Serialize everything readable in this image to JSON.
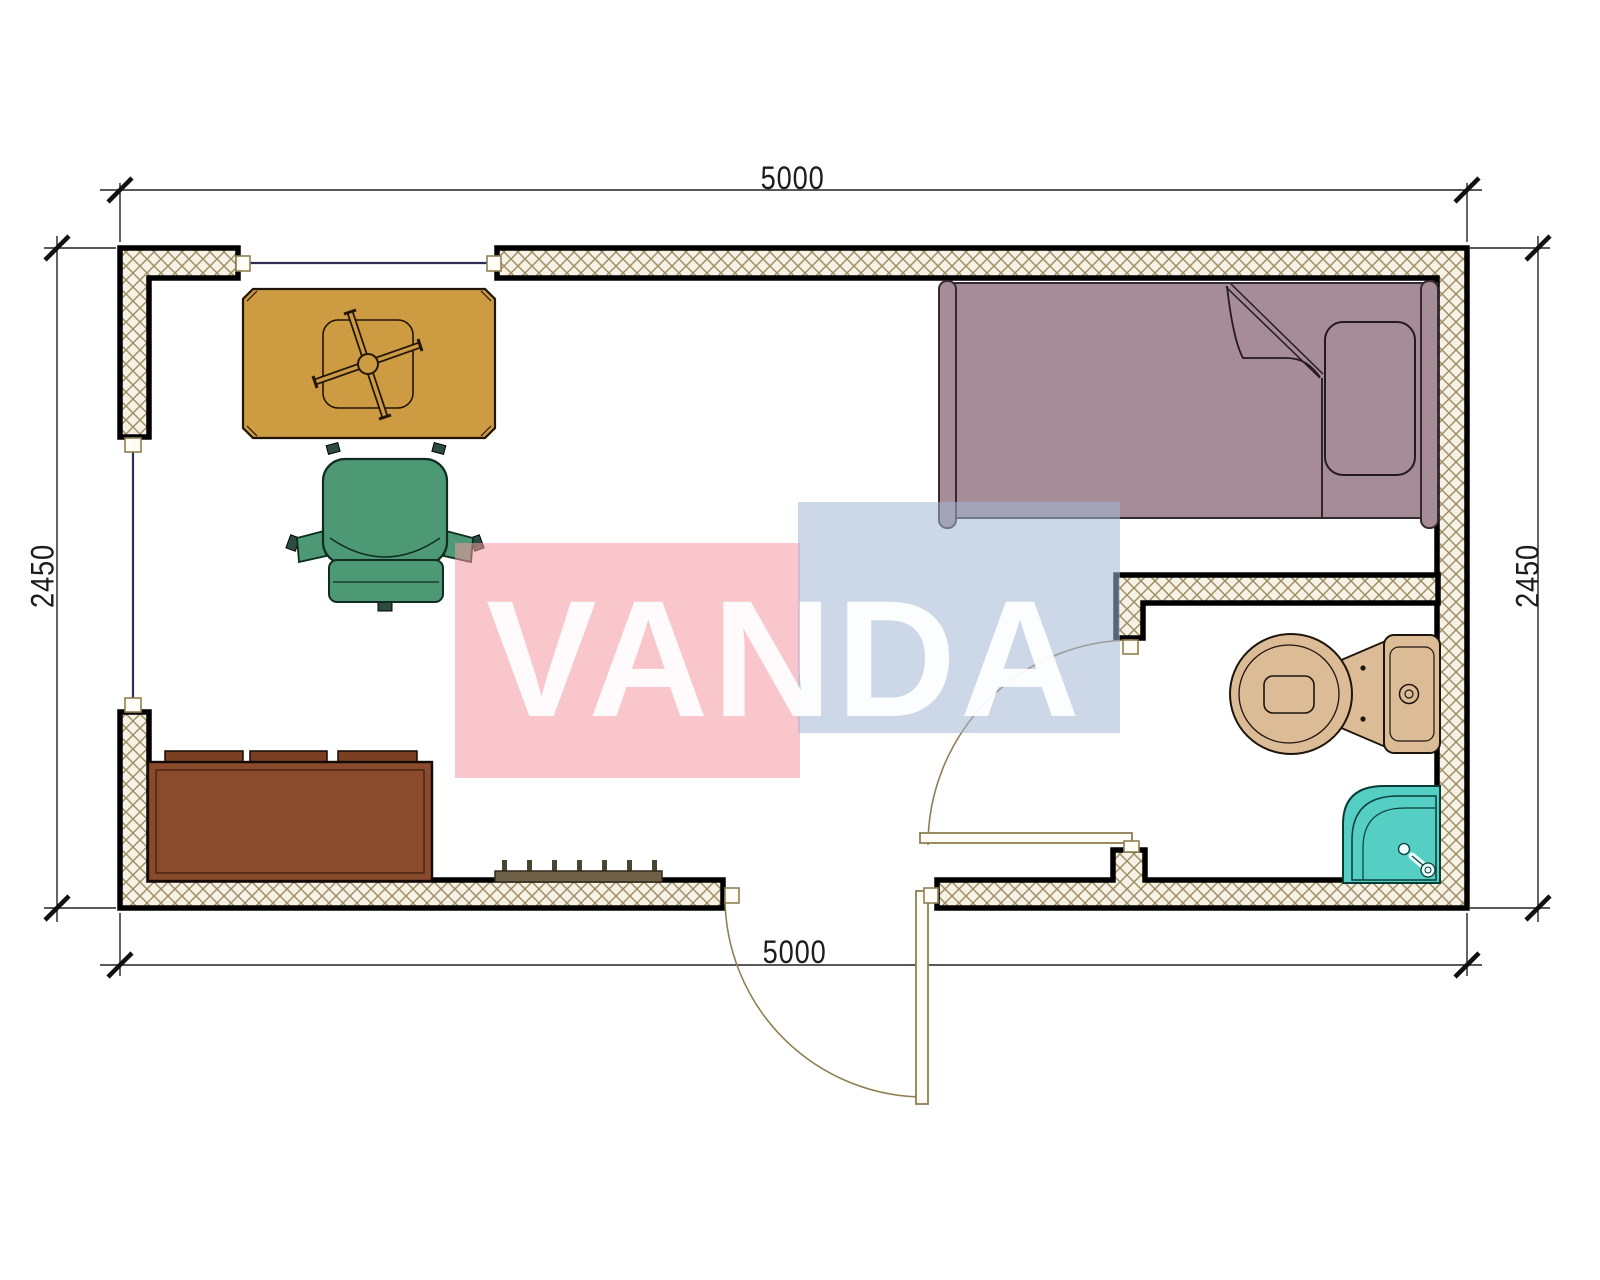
{
  "drawing": {
    "title_visible_text": [
      "5000",
      "2450",
      "VANDA"
    ],
    "dimensions": {
      "top": "5000",
      "bottom": "5000",
      "left": "2450",
      "right": "2450"
    },
    "watermark": {
      "text": "VANDA",
      "pink_square_color": "#F497A2",
      "blue_square_color": "#A2B8D5",
      "text_color": "#FFFFFF"
    },
    "walls": {
      "fill": "#F6F2E6",
      "hatch_color": "#A08F66",
      "outline_color": "#000000"
    },
    "windows": {
      "glass_line_color": "#2E2E55"
    },
    "doors": {
      "swing_color": "#8F7F52",
      "leaf_fill": "#FFFDF5"
    },
    "furniture": {
      "desk": {
        "color": "#CD9B41"
      },
      "desk_fan": {
        "color": "#CD9B41"
      },
      "office_chair": {
        "color": "#4D9976"
      },
      "sofa": {
        "color": "#8A4A2C"
      },
      "sofa_cushions": {
        "color": "#7A4024"
      },
      "bed": {
        "color": "#A58C96"
      },
      "toilet": {
        "color": "#DCBB97"
      },
      "shower_tray": {
        "color": "#55CFC4"
      },
      "radiator": {
        "color": "#6F6148"
      }
    }
  }
}
